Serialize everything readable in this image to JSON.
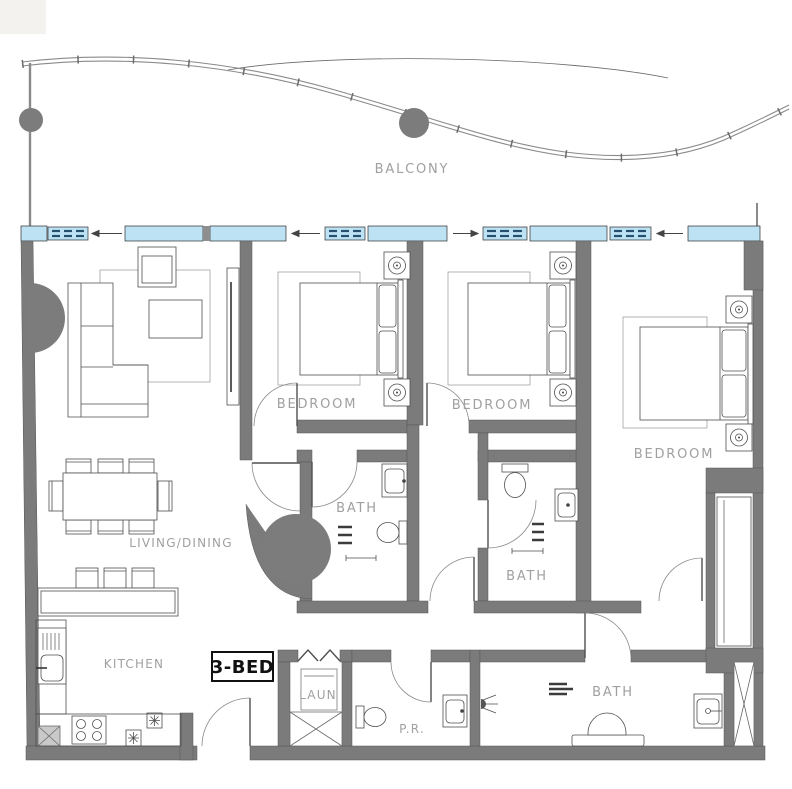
{
  "plan": {
    "title": "3-bedroom apartment floor plan",
    "labels": {
      "balcony": "BALCONY",
      "bedroom_1": "BEDROOM",
      "bedroom_2": "BEDROOM",
      "bedroom_3": "BEDROOM",
      "living_dining": "LIVING/DINING",
      "kitchen": "KITCHEN",
      "bath_1": "BATH",
      "bath_2": "BATH",
      "bath_3": "BATH",
      "laundry": "LAUN",
      "powder_room": "P.R.",
      "unit_type": "3-BED"
    },
    "colors": {
      "wall": "#7b7b7b",
      "column": "#7c7c7c",
      "window_glass": "#bce2f4",
      "glass_dash": "#24506e",
      "furniture_line": "#4f4f4f",
      "label_text": "#a0a0a0",
      "unit_label_text": "#111111",
      "background": "#ffffff"
    }
  }
}
